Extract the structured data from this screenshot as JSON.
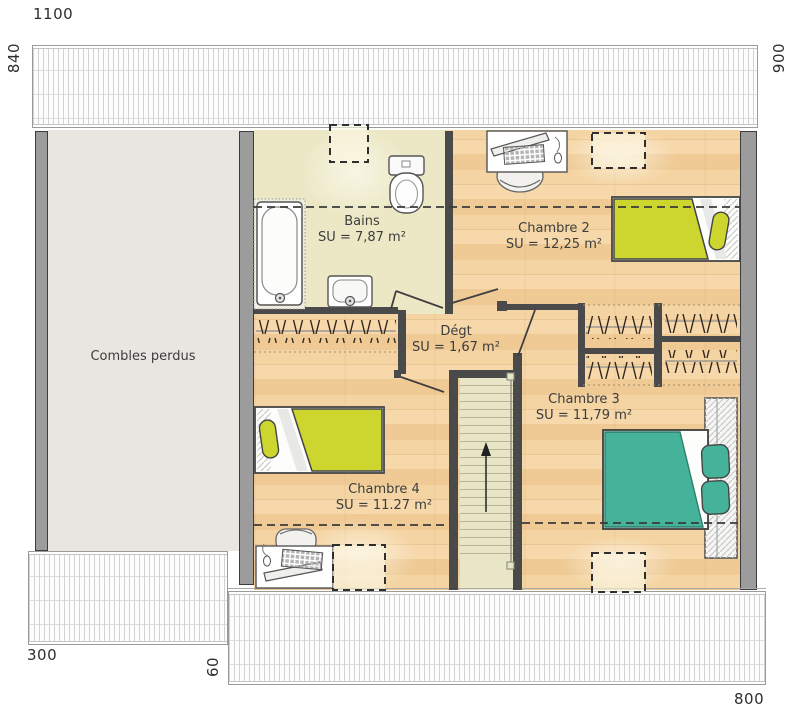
{
  "dimensions": {
    "top": "1100",
    "left": "840",
    "right": "900",
    "bottom_left": "300",
    "bottom_offset": "60",
    "bottom_right": "800"
  },
  "rooms": {
    "combles": {
      "name": "Combles perdus"
    },
    "bains": {
      "name": "Bains",
      "area": "SU = 7,87 m²"
    },
    "chambre2": {
      "name": "Chambre 2",
      "area": "SU = 12,25 m²"
    },
    "degagement": {
      "name": "Dégt",
      "area": "SU = 1,67 m²"
    },
    "chambre3": {
      "name": "Chambre 3",
      "area": "SU = 11,79 m²"
    },
    "chambre4": {
      "name": "Chambre 4",
      "area": "SU = 11.27 m²"
    }
  },
  "colors": {
    "wood_floor": "#f2d0a0",
    "bains_floor": "#ece8c6",
    "combles_floor": "#e9e5e1",
    "stairs_floor": "#e9e6c8",
    "wall_dark": "#4a4a4a",
    "wall_gray": "#9c9c9c",
    "bed_yellow": "#cdd62f",
    "bed_teal": "#45b39a"
  }
}
